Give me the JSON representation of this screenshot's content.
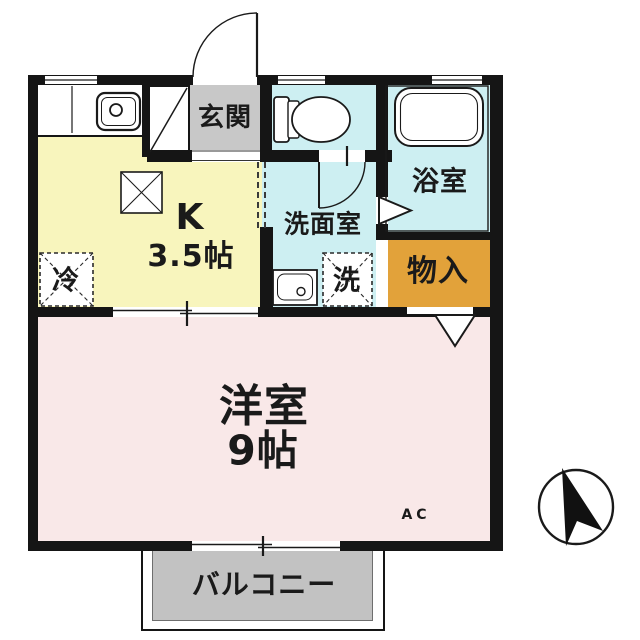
{
  "plan": {
    "rooms": {
      "genkan": {
        "label": "玄関"
      },
      "kitchen": {
        "type_label": "K",
        "size_label": "3.5帖"
      },
      "washroom": {
        "label": "洗面室"
      },
      "bathroom": {
        "label": "浴室"
      },
      "storage": {
        "label": "物入"
      },
      "western": {
        "label": "洋室",
        "size_label": "9帖"
      },
      "balcony": {
        "label": "バルコニー"
      }
    },
    "fixtures": {
      "refrigerator": {
        "label": "冷"
      },
      "washing_machine": {
        "label": "洗"
      },
      "air_conditioner": {
        "label": "AC"
      }
    },
    "colors": {
      "kitchen": "#F8F5BD",
      "western_room": "#F9E8E8",
      "wet_area": "#CDEFF2",
      "storage": "#E2A23A",
      "genkan": "#C8C8C8",
      "balcony": "#C2C2C2",
      "wall": "#151515"
    }
  }
}
